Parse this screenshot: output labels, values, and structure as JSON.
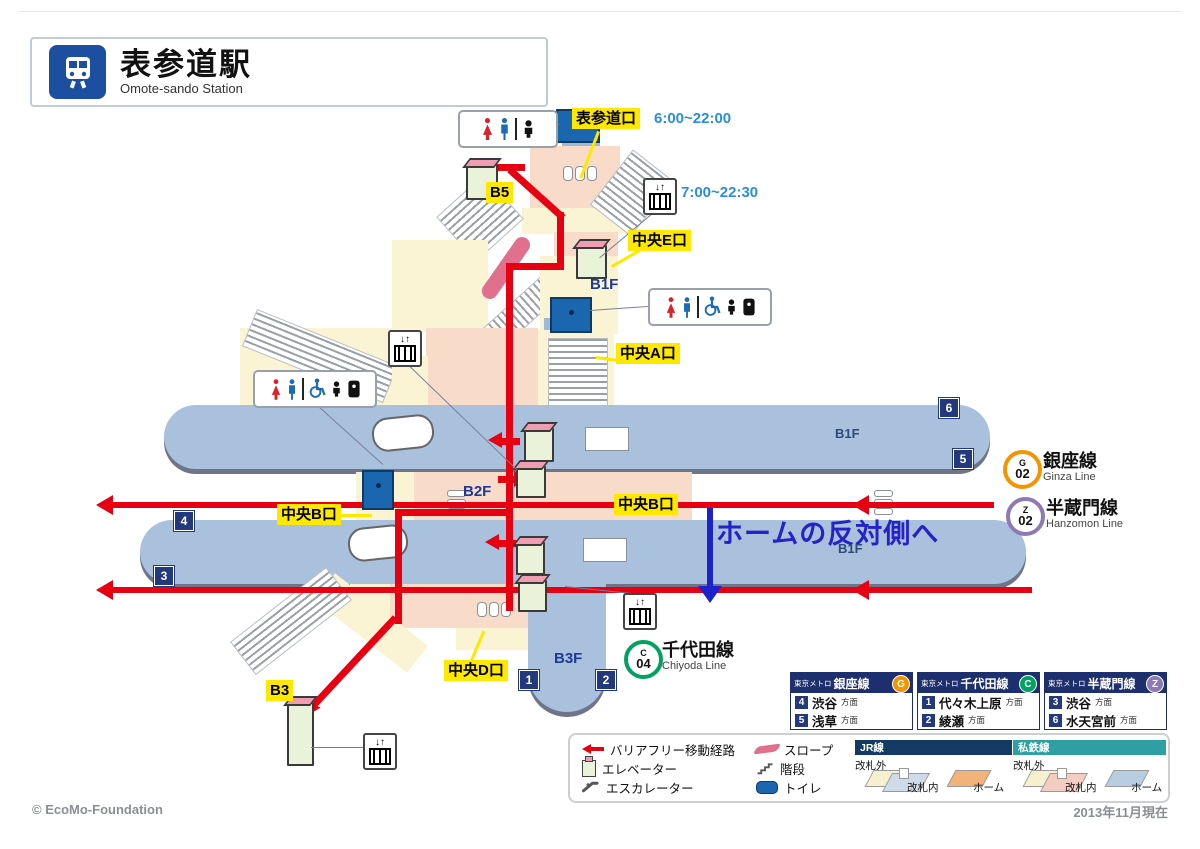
{
  "station": {
    "title_ja": "表参道駅",
    "title_en": "Omote-sando Station"
  },
  "exit_labels": {
    "omotesando": "表参道口",
    "chuo_e": "中央E口",
    "chuo_a": "中央A口",
    "chuo_b": "中央B口",
    "chuo_d": "中央D口"
  },
  "hours": {
    "omotesando_exit": "6:00~22:00",
    "elevator": "7:00~22:30"
  },
  "floor_labels": {
    "b5": "B5",
    "b3": "B3",
    "b1f": "B1F",
    "b2f": "B2F",
    "b3f": "B3F"
  },
  "platform_numbers": {
    "upper_outer": "6",
    "upper_inner": "5",
    "lower_outer": "4",
    "lower_inner": "3",
    "chiyoda_left": "1",
    "chiyoda_right": "2"
  },
  "lines": {
    "ginza": {
      "name_ja": "銀座線",
      "name_en": "Ginza Line",
      "letter": "G",
      "number": "02",
      "color": "#f29500"
    },
    "hanzomon": {
      "name_ja": "半蔵門線",
      "name_en": "Hanzomon Line",
      "letter": "Z",
      "number": "02",
      "color": "#8d7ab5"
    },
    "chiyoda": {
      "name_ja": "千代田線",
      "name_en": "Chiyoda Line",
      "letter": "C",
      "number": "04",
      "color": "#00a162"
    }
  },
  "note": "ホームの反対側へ",
  "direction_boxes": [
    {
      "operator": "東京メトロ",
      "line": "銀座線",
      "letter": "G",
      "rows": [
        {
          "num": "4",
          "dest": "渋谷",
          "suffix": "方面"
        },
        {
          "num": "5",
          "dest": "浅草",
          "suffix": "方面"
        }
      ]
    },
    {
      "operator": "東京メトロ",
      "line": "千代田線",
      "letter": "C",
      "rows": [
        {
          "num": "1",
          "dest": "代々木上原",
          "suffix": "方面"
        },
        {
          "num": "2",
          "dest": "綾瀬",
          "suffix": "方面"
        }
      ]
    },
    {
      "operator": "東京メトロ",
      "line": "半蔵門線",
      "letter": "Z",
      "rows": [
        {
          "num": "3",
          "dest": "渋谷",
          "suffix": "方面"
        },
        {
          "num": "6",
          "dest": "水天宮前",
          "suffix": "方面"
        }
      ]
    }
  ],
  "legend": {
    "route": "バリアフリー移動経路",
    "elevator": "エレベーター",
    "escalator": "エスカレーター",
    "slope": "スロープ",
    "stairs": "階段",
    "toilet": "トイレ",
    "jr": {
      "title": "JR線",
      "outside": "改札外",
      "inside": "改札内",
      "platform": "ホーム"
    },
    "private": {
      "title": "私鉄線",
      "outside": "改札外",
      "inside": "改札内",
      "platform": "ホーム"
    }
  },
  "footer": {
    "copyright": "© EcoMo-Foundation",
    "date": "2013年11月現在"
  },
  "colors": {
    "route_red": "#e60012",
    "label_yellow": "#ffe800",
    "floor_blue": "#1d3a96",
    "platform_fill": "#a9c1dc",
    "concourse_pink": "#f8dcc9",
    "concourse_cream": "#faf3d4",
    "jr_header": "#123a63",
    "private_header": "#2f9fa4",
    "note_blue": "#2323c8"
  }
}
